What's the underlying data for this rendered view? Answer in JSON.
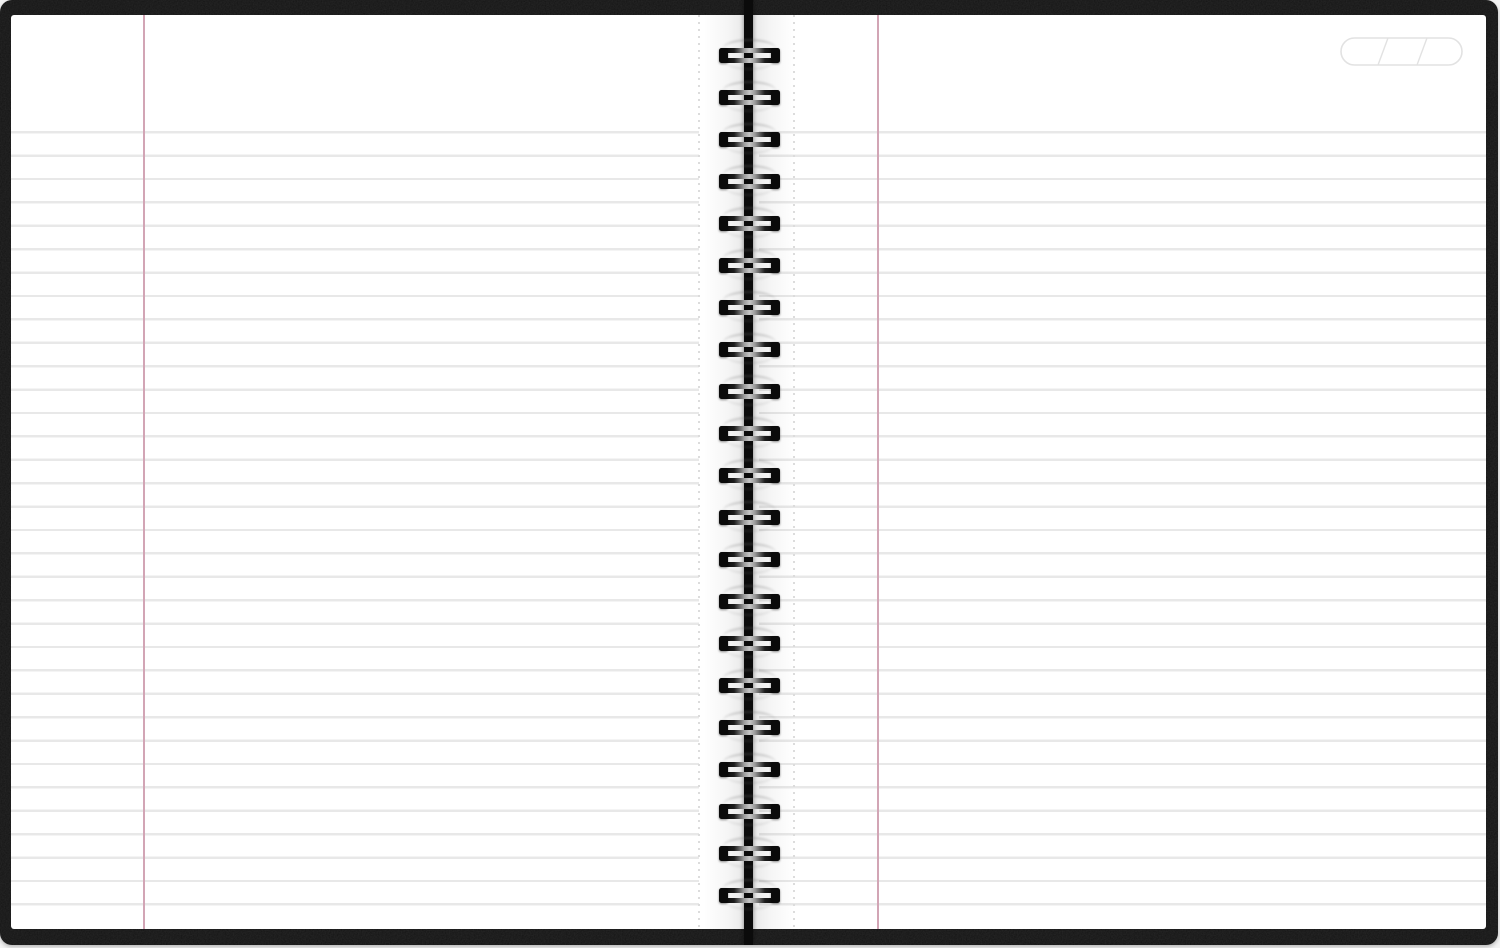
{
  "scene": {
    "description": "Open twin-wire spiral-bound notebook with blank ruled white pages and a black leather cover",
    "cover": {
      "color": "#141414",
      "border_radius_px": 12
    },
    "page": {
      "color": "#ffffff"
    },
    "ruling": {
      "line_color": "#e8e8e8",
      "line_thickness_px": 2.4,
      "spacing_px": 23.4,
      "first_line_y_px": 131,
      "line_count_per_page": 34
    },
    "margin_line": {
      "color": "#d2a5b5",
      "left_page_x_px": 143,
      "right_page_x_px": 877
    },
    "perforation_line": {
      "color": "#dcdcdc",
      "left_page_x_px": 698,
      "right_page_x_px": 793
    },
    "binding": {
      "type": "twin-wire-o-spiral",
      "coil_count": 21,
      "first_coil_top_y_px": 48,
      "coil_pitch_px": 42,
      "coil_width_px": 61,
      "coil_height_px": 15,
      "wire_color": "#0a0a0a",
      "spine_color": "#0b0b0b"
    },
    "corner_stamp": {
      "shape": "rounded-pill-outline",
      "segments": 3,
      "stroke_color": "#e2e2e2",
      "x_px": 1340,
      "y_px": 37,
      "width_px": 123,
      "height_px": 29
    }
  }
}
